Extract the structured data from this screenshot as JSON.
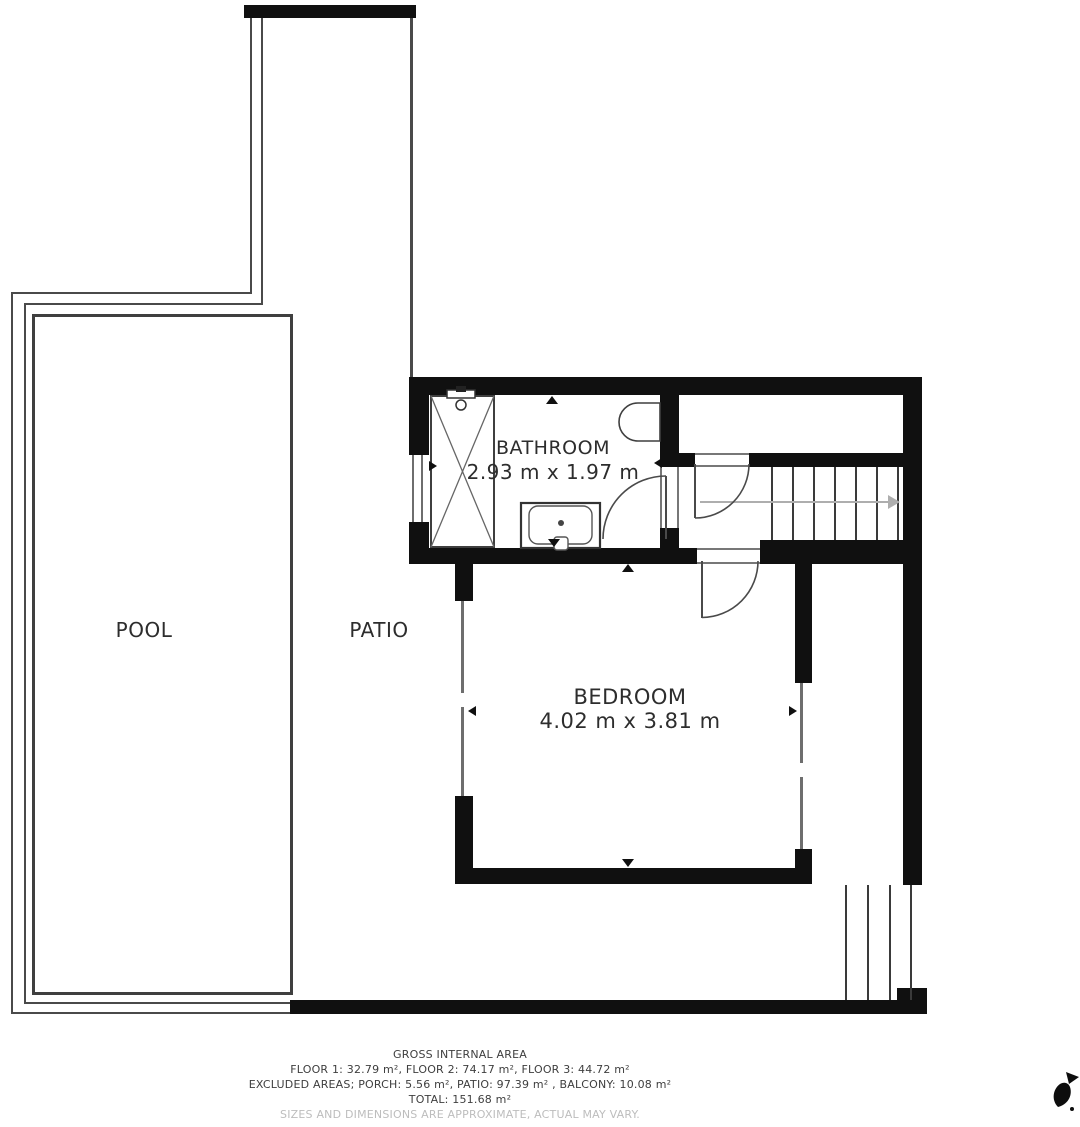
{
  "colors": {
    "wall": "#101010",
    "outline": "#4a4a4a",
    "window": "#6e6e6e",
    "fixture": "#3f3f3f",
    "stair": "#3a3a3a",
    "arrow": "#aeaeae",
    "text": "#2d2d2d",
    "footer-text": "#3e3e3e",
    "muted": "#bdbdbd",
    "background": "#ffffff"
  },
  "rooms": {
    "pool": {
      "label": "POOL"
    },
    "patio": {
      "label": "PATIO"
    },
    "bathroom": {
      "label": "BATHROOM",
      "dimensions": "2.93 m x 1.97 m"
    },
    "bedroom": {
      "label": "BEDROOM",
      "dimensions": "4.02 m x 3.81 m"
    }
  },
  "footer": {
    "title": "GROSS INTERNAL AREA",
    "floors": "FLOOR 1: 32.79 m², FLOOR 2: 74.17 m², FLOOR 3: 44.72 m²",
    "excluded": "EXCLUDED AREAS; PORCH: 5.56 m², PATIO: 97.39 m² , BALCONY: 10.08 m²",
    "total": "TOTAL: 151.68 m²",
    "disclaimer": "SIZES AND DIMENSIONS ARE APPROXIMATE, ACTUAL MAY VARY."
  },
  "icons": {
    "logo": "bird-logo"
  }
}
